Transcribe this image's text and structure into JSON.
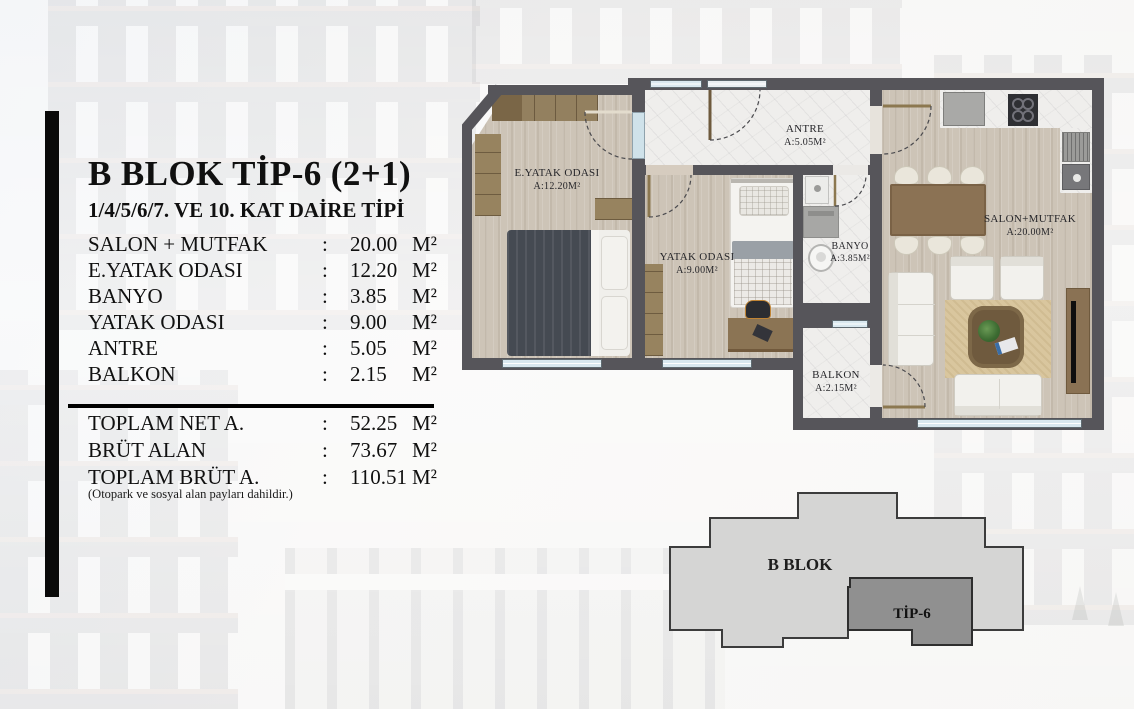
{
  "header": {
    "title": "B BLOK TİP-6 (2+1)",
    "subtitle": "1/4/5/6/7. VE 10. KAT DAİRE TİPİ"
  },
  "colon": ":",
  "rooms": [
    {
      "label": "SALON + MUTFAK",
      "value": "20.00",
      "unit": "M²"
    },
    {
      "label": "E.YATAK ODASI",
      "value": "12.20",
      "unit": "M²"
    },
    {
      "label": "BANYO",
      "value": "3.85",
      "unit": "M²"
    },
    {
      "label": "YATAK ODASI",
      "value": "9.00",
      "unit": "M²"
    },
    {
      "label": "ANTRE",
      "value": "5.05",
      "unit": "M²"
    },
    {
      "label": "BALKON",
      "value": "2.15",
      "unit": "M²"
    }
  ],
  "totals": [
    {
      "label": "TOPLAM NET A.",
      "value": "52.25",
      "unit": "M²"
    },
    {
      "label": "BRÜT ALAN",
      "value": "73.67",
      "unit": "M²"
    },
    {
      "label": "TOPLAM BRÜT A.",
      "value": "110.51",
      "unit": "M²"
    }
  ],
  "totals_note": "(Otopark ve sosyal alan payları dahildir.)",
  "floorplan": {
    "labels": [
      {
        "name": "E.YATAK ODASI",
        "area": "A:12.20M²"
      },
      {
        "name": "ANTRE",
        "area": "A:5.05M²"
      },
      {
        "name": "YATAK ODASI",
        "area": "A:9.00M²"
      },
      {
        "name": "BANYO",
        "area": "A:3.85M²"
      },
      {
        "name": "BALKON",
        "area": "A:2.15M²"
      },
      {
        "name": "SALON+MUTFAK",
        "area": "A:20.00M²"
      }
    ]
  },
  "block_diagram": {
    "block": "B BLOK",
    "unit": "TİP-6"
  },
  "colors": {
    "wall": "#56555a",
    "wood_floor": "#cdc4b7",
    "marble_floor": "#efeeec",
    "furniture_wood": "#8c7850",
    "window_glass": "#d9e8ef",
    "block_light": "#d5d5d4",
    "block_dark": "#909090",
    "side_bar": "#0a0a0a"
  }
}
